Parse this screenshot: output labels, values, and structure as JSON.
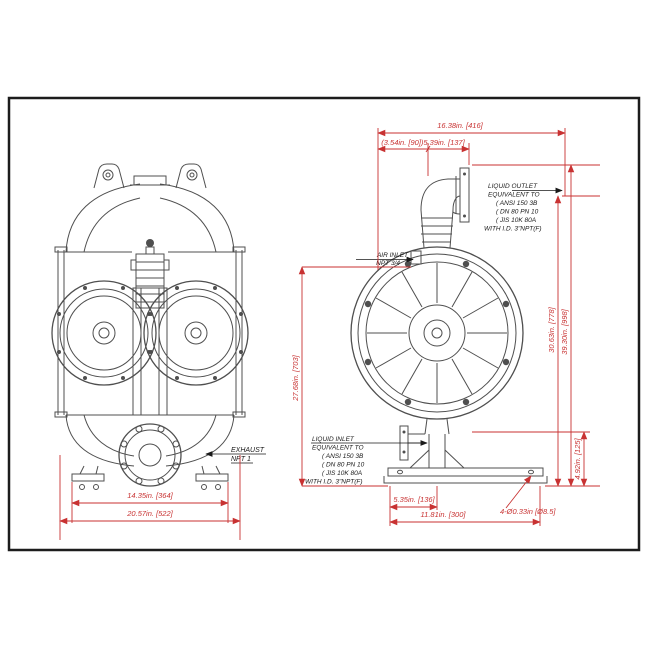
{
  "drawing": {
    "border_color": "#1c1c1c",
    "art_color": "#4f4f4f",
    "dimension_color": "#c83232",
    "label_color": "#1a1a1a"
  },
  "front_view": {
    "exhaust_label": {
      "line1": "EXHAUST",
      "line2": "NPT 1"
    },
    "dims": {
      "feet_span": "14.35in. [364]",
      "overall_width": "20.57in. [522]"
    }
  },
  "side_view": {
    "liquid_outlet_label": [
      "LIQUID OUTLET",
      "EQUIVALENT TO",
      "( ANSI 150 3B",
      "( DN 80 PN 10",
      "( JIS 10K 80A",
      "WITH I.D. 3\"NPT(F)"
    ],
    "air_inlet_label": [
      "AIR INLET",
      "NPT 3/4"
    ],
    "liquid_inlet_label": [
      "LIQUID INLET",
      "EQUIVALENT TO",
      "( ANSI 150 3B",
      "( DN 80 PN 10",
      "( JIS 10K 80A",
      "WITH I.D. 3\"NPT(F)"
    ],
    "dims": {
      "top_overall": "16.38in. [416]",
      "top_split": "(3.54in. [90])5.39in. [137]",
      "height_air_to_base": "27.68in. [703]",
      "height_outlet": "30.63in. [778]",
      "height_overall": "39.30in. [998]",
      "base_height": "4.92in. [125]",
      "bolt_offset": "5.35in. [136]",
      "base_width": "11.81in. [300]",
      "anchor_holes": "4-Ø0.33in [Ø8.5]"
    }
  }
}
